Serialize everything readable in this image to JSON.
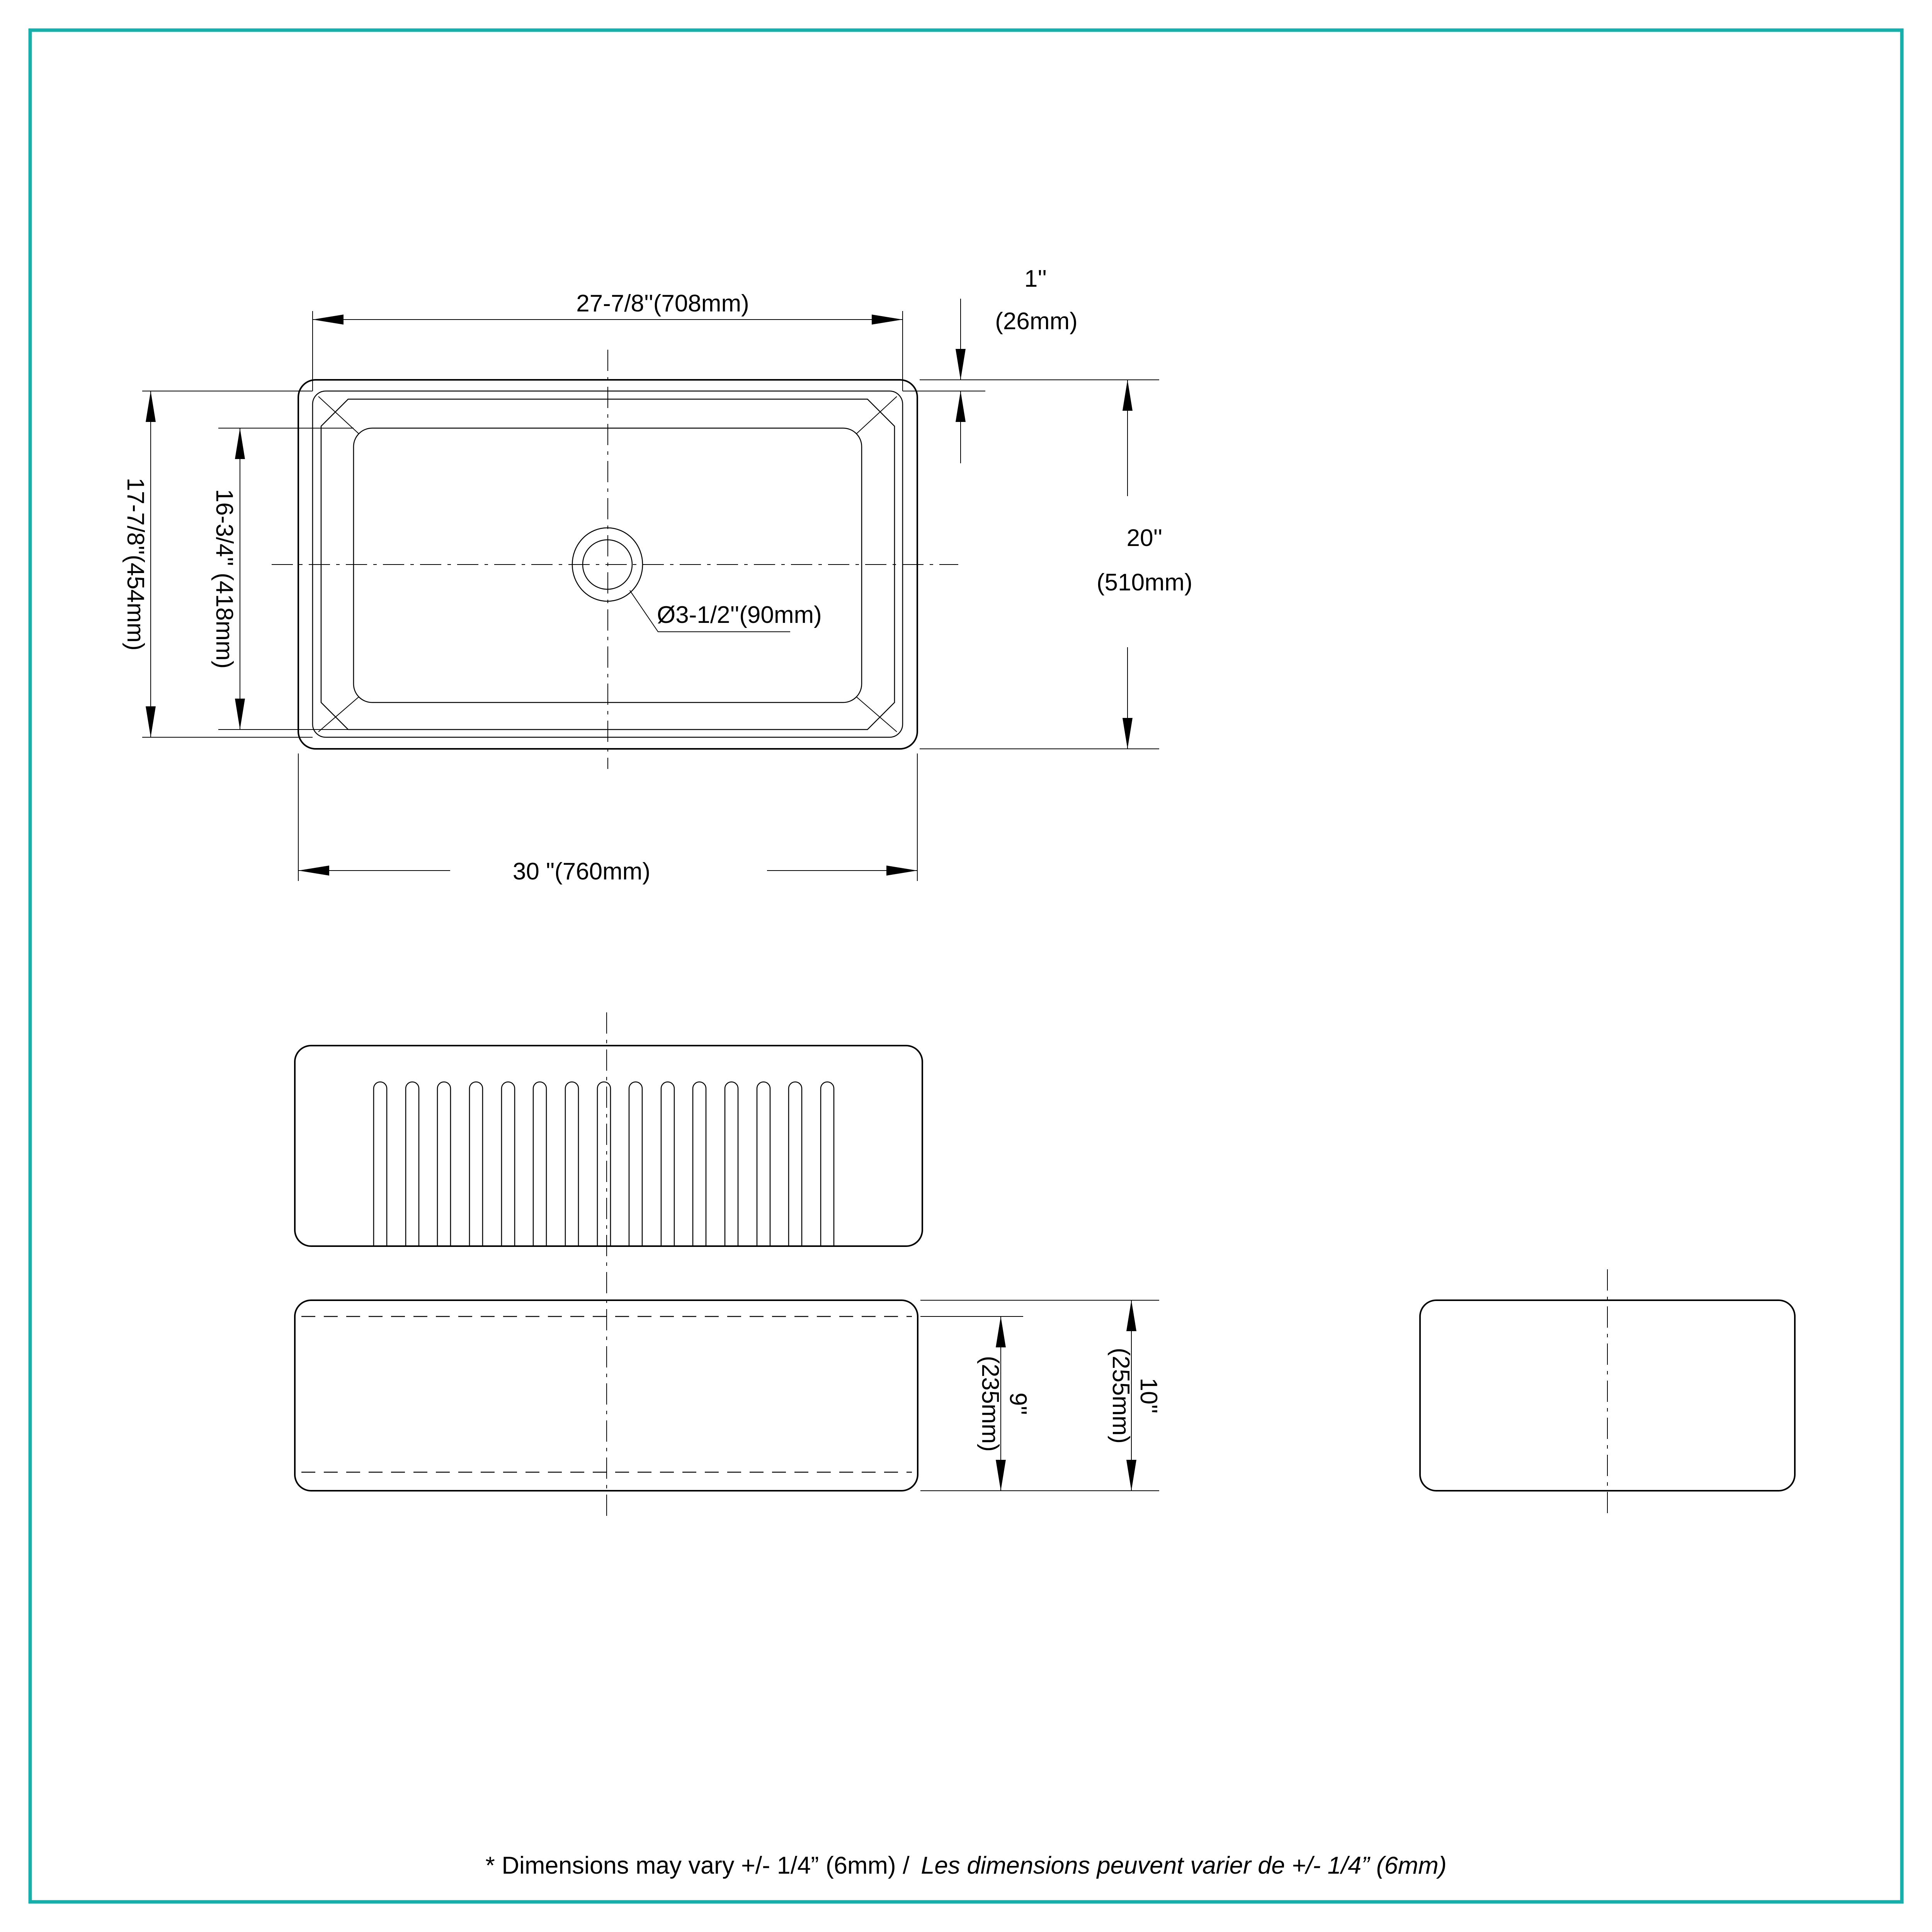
{
  "page": {
    "background": "#ffffff",
    "border_color": "#17afac"
  },
  "top_view": {
    "inner_width": "27-7/8''(708mm)",
    "rim_width_in": "1''",
    "rim_width_mm": "(26mm)",
    "front_to_back_in": "20''",
    "front_to_back_mm": "(510mm)",
    "outer_depth": "17-7/8''(454mm)",
    "inner_depth": "16-3/4'' (418mm)",
    "overall_width": "30 \"(760mm)",
    "drain": "Ø3-1/2''(90mm)"
  },
  "front_view": {
    "flute_count": 15
  },
  "side_views": {
    "apron_height_in": "9''",
    "apron_height_mm": "(235mm)",
    "overall_height_in": "10''",
    "overall_height_mm": "(255mm)"
  },
  "footer": {
    "note_en": "* Dimensions may vary +/- 1/4” (6mm) /",
    "note_fr": "Les dimensions peuvent varier de +/- 1/4” (6mm)"
  }
}
